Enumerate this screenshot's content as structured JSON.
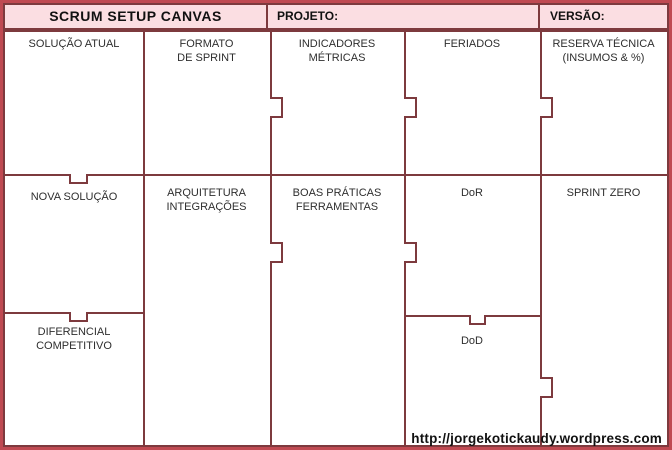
{
  "header": {
    "title": "SCRUM SETUP CANVAS",
    "projeto": "PROJETO:",
    "versao": "VERSÃO:"
  },
  "cells": {
    "solucao_atual": "SOLUÇÃO ATUAL",
    "formato_sprint": "FORMATO\nDE SPRINT",
    "indicadores_metricas": "INDICADORES\nMÉTRICAS",
    "feriados": "FERIADOS",
    "reserva_tecnica": "RESERVA TÉCNICA\n(INSUMOS & %)",
    "nova_solucao": "NOVA SOLUÇÃO",
    "arquitetura_integracoes": "ARQUITETURA\nINTEGRAÇÕES",
    "boas_praticas_ferramentas": "BOAS PRÁTICAS\nFERRAMENTAS",
    "dor": "DoR",
    "sprint_zero": "SPRINT ZERO",
    "diferencial_competitivo": "DIFERENCIAL\nCOMPETITIVO",
    "dod": "DoD"
  },
  "footer": {
    "url": "http://jorgekotickaudy.wordpress.com"
  },
  "colors": {
    "outer_border": "#bf4a52",
    "grid_line": "#7d3a3e",
    "header_bg": "#fbdee2",
    "label_text": "#2e2e2e"
  }
}
